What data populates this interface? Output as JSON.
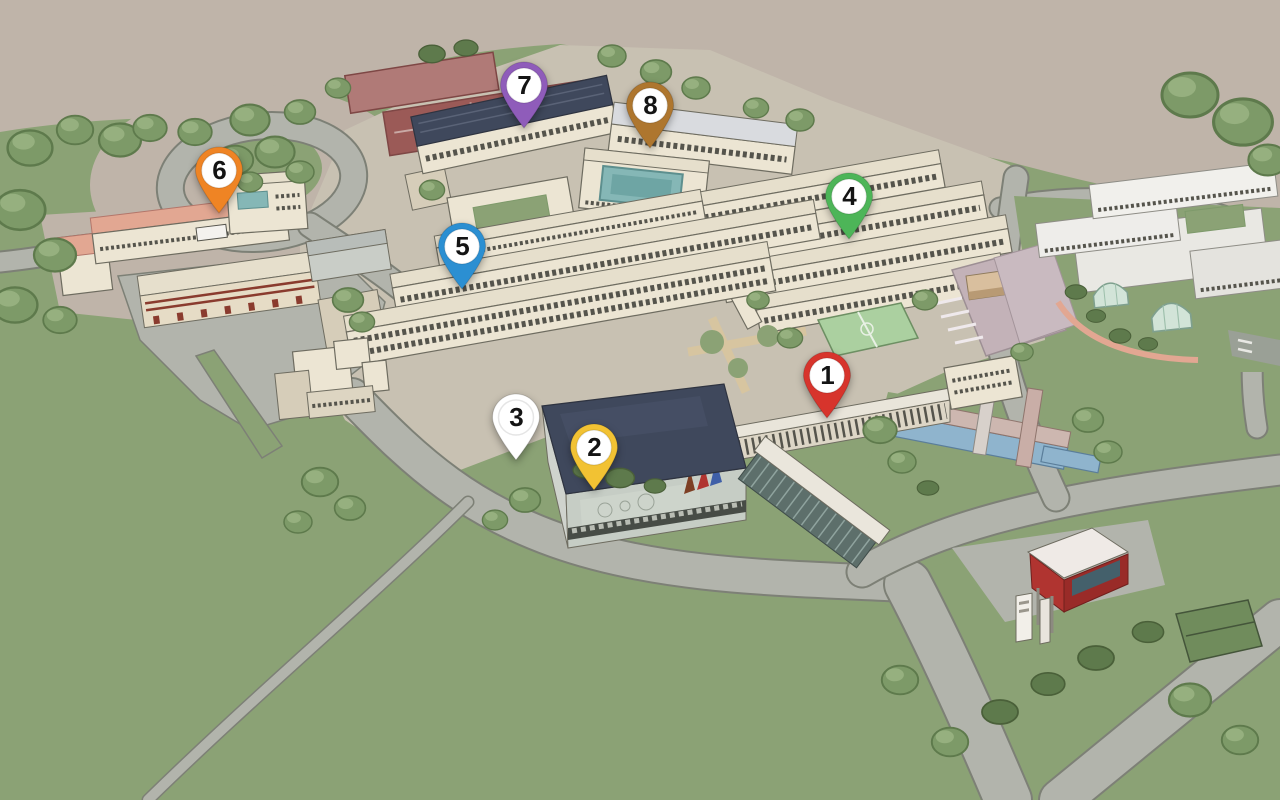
{
  "map": {
    "pin_count": 8,
    "pins": "numbered location markers 1-8"
  },
  "pins": [
    {
      "number": "1",
      "color": "#d7342c",
      "x": 827,
      "y": 420
    },
    {
      "number": "2",
      "color": "#f2c233",
      "x": 594,
      "y": 492
    },
    {
      "number": "3",
      "color": "#ffffff",
      "x": 516,
      "y": 462
    },
    {
      "number": "4",
      "color": "#4db558",
      "x": 849,
      "y": 241
    },
    {
      "number": "5",
      "color": "#2b8fd2",
      "x": 462,
      "y": 291
    },
    {
      "number": "6",
      "color": "#ef8424",
      "x": 219,
      "y": 215
    },
    {
      "number": "7",
      "color": "#8f5cba",
      "x": 524,
      "y": 130
    },
    {
      "number": "8",
      "color": "#ae762e",
      "x": 650,
      "y": 150
    }
  ],
  "palette": {
    "bg": "#bfb4a9",
    "grass": "#8ba275",
    "grass-dark": "#7c9465",
    "paving": "#c8c1b2",
    "road": "#b2b4ac",
    "road-edge": "#7d8076",
    "bldg": "#ece5d3",
    "bldg-side": "#d6cdb9",
    "roof": "#e6dfcc",
    "roof-dark": "#3f485c",
    "line": "#6e6c60",
    "win": "#55544c",
    "water": "#8fb4cd",
    "court": "#9b5a57",
    "court-light": "#b07a77",
    "sport-green": "#abd0a0",
    "mauve": "#c3b2b8",
    "kiosk-red": "#b03430",
    "salmon": "#e2a792",
    "tree": "#7d9a68",
    "tree-dark": "#5e7a4c",
    "pool-teal": "#85b7b6"
  }
}
